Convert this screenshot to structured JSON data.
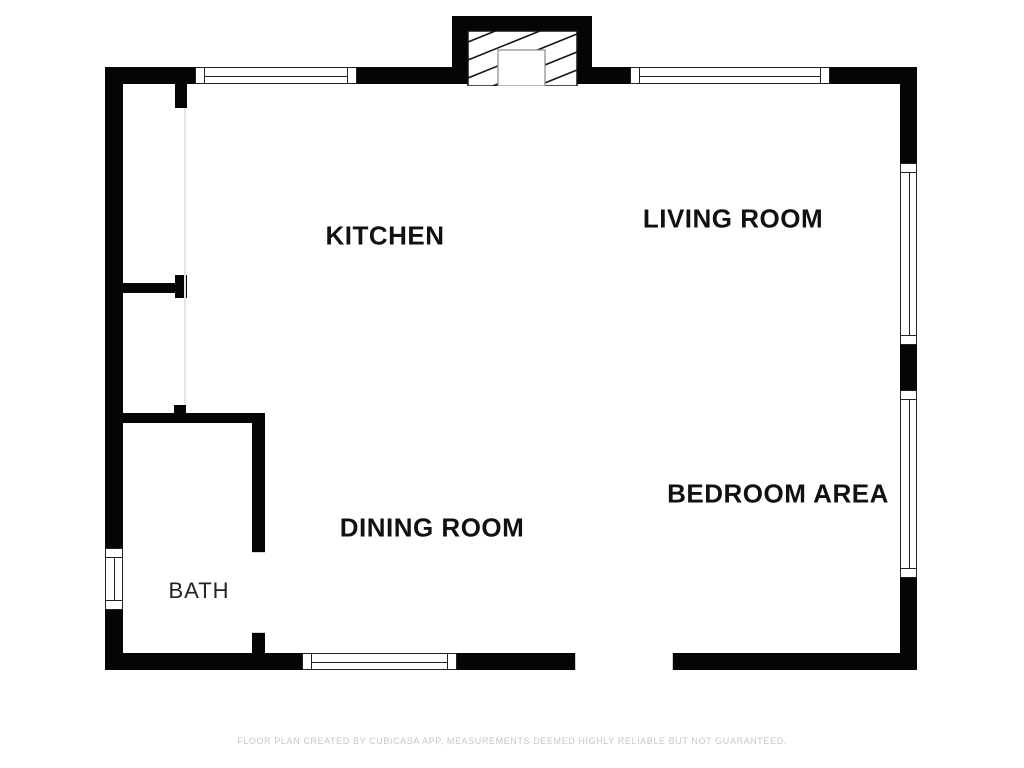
{
  "rooms": {
    "kitchen": "KITCHEN",
    "living_room": "LIVING ROOM",
    "dining_room": "DINING ROOM",
    "bedroom_area": "BEDROOM AREA",
    "bath": "BATH"
  },
  "footer": {
    "disclaimer": "FLOOR PLAN CREATED BY CUBICASA APP, MEASUREMENTS DEEMED HIGHLY RELIABLE BUT NOT GUARANTEED."
  },
  "colors": {
    "wall": "#050505",
    "background": "#ffffff",
    "hatch_line": "#151515",
    "window_frame": "#222222",
    "divider_line": "#e4e4e4",
    "footer_text": "#c7c7c7"
  }
}
